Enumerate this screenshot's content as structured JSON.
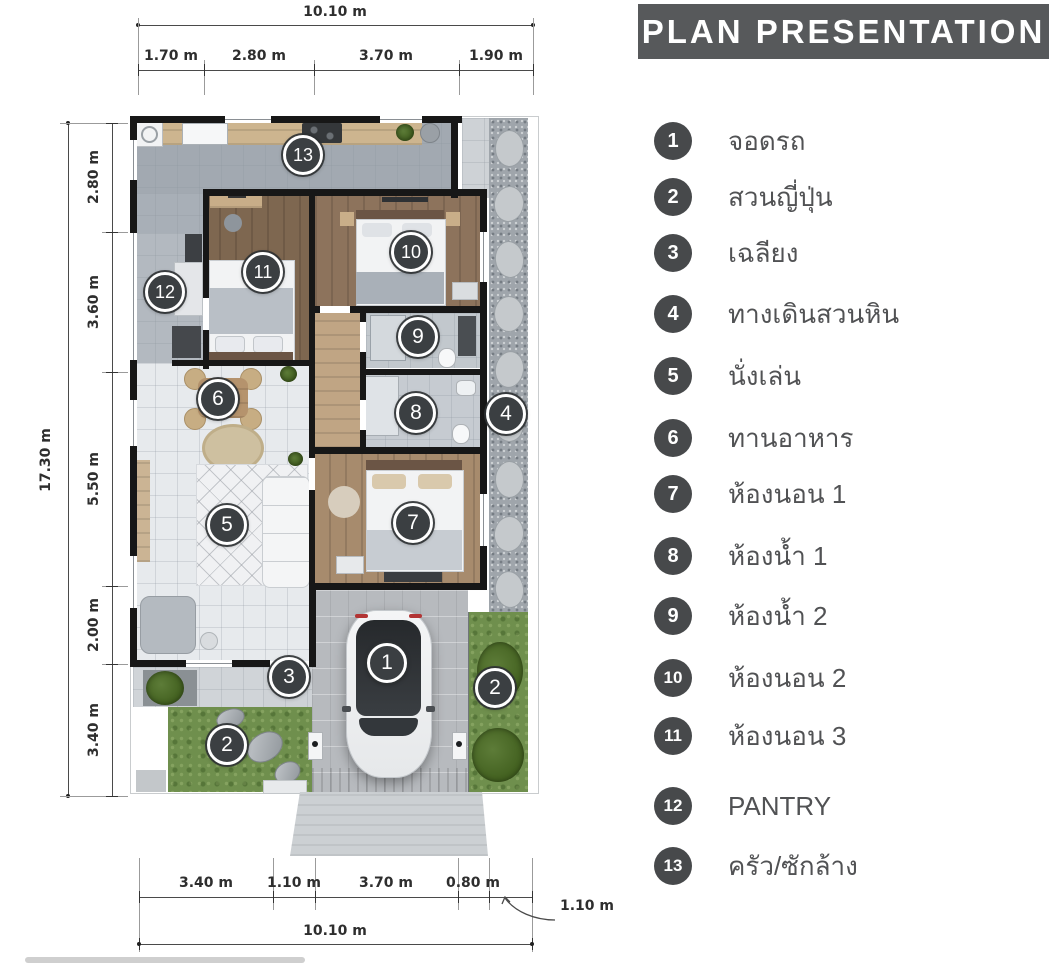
{
  "title": "PLAN PRESENTATION",
  "legend": {
    "items": [
      {
        "num": "1",
        "label": "จอดรถ"
      },
      {
        "num": "2",
        "label": "สวนญี่ปุ่น"
      },
      {
        "num": "3",
        "label": "เฉลียง"
      },
      {
        "num": "4",
        "label": "ทางเดินสวนหิน"
      },
      {
        "num": "5",
        "label": "นั่งเล่น"
      },
      {
        "num": "6",
        "label": "ทานอาหาร"
      },
      {
        "num": "7",
        "label": "ห้องนอน 1"
      },
      {
        "num": "8",
        "label": "ห้องน้ำ 1"
      },
      {
        "num": "9",
        "label": "ห้องน้ำ 2"
      },
      {
        "num": "10",
        "label": "ห้องนอน 2"
      },
      {
        "num": "11",
        "label": "ห้องนอน 3"
      },
      {
        "num": "12",
        "label": "PANTRY"
      },
      {
        "num": "13",
        "label": "ครัว/ซักล้าง"
      }
    ]
  },
  "plan": {
    "markers": [
      "1",
      "2",
      "2",
      "3",
      "4",
      "5",
      "6",
      "7",
      "8",
      "9",
      "10",
      "11",
      "12",
      "13"
    ],
    "dimensions": {
      "top_overall": "10.10 m",
      "top_segments": [
        "1.70 m",
        "2.80 m",
        "3.70 m",
        "1.90 m"
      ],
      "left_overall": "17.30 m",
      "left_segments": [
        "2.80 m",
        "3.60 m",
        "5.50 m",
        "2.00 m",
        "3.40 m"
      ],
      "bottom_segments": [
        "3.40 m",
        "1.10 m",
        "3.70 m",
        "0.80 m"
      ],
      "bottom_leader": "1.10 m",
      "bottom_overall": "10.10 m"
    }
  },
  "colors": {
    "title_bar": "#57595b",
    "legend_circle": "#47494b",
    "marker": "#3b3f42",
    "wall": "#171717",
    "grass": "#6f8f4d",
    "wood": "#8d735c",
    "living_tile": "#e7eaed",
    "gravel": "#9fa5ab"
  }
}
